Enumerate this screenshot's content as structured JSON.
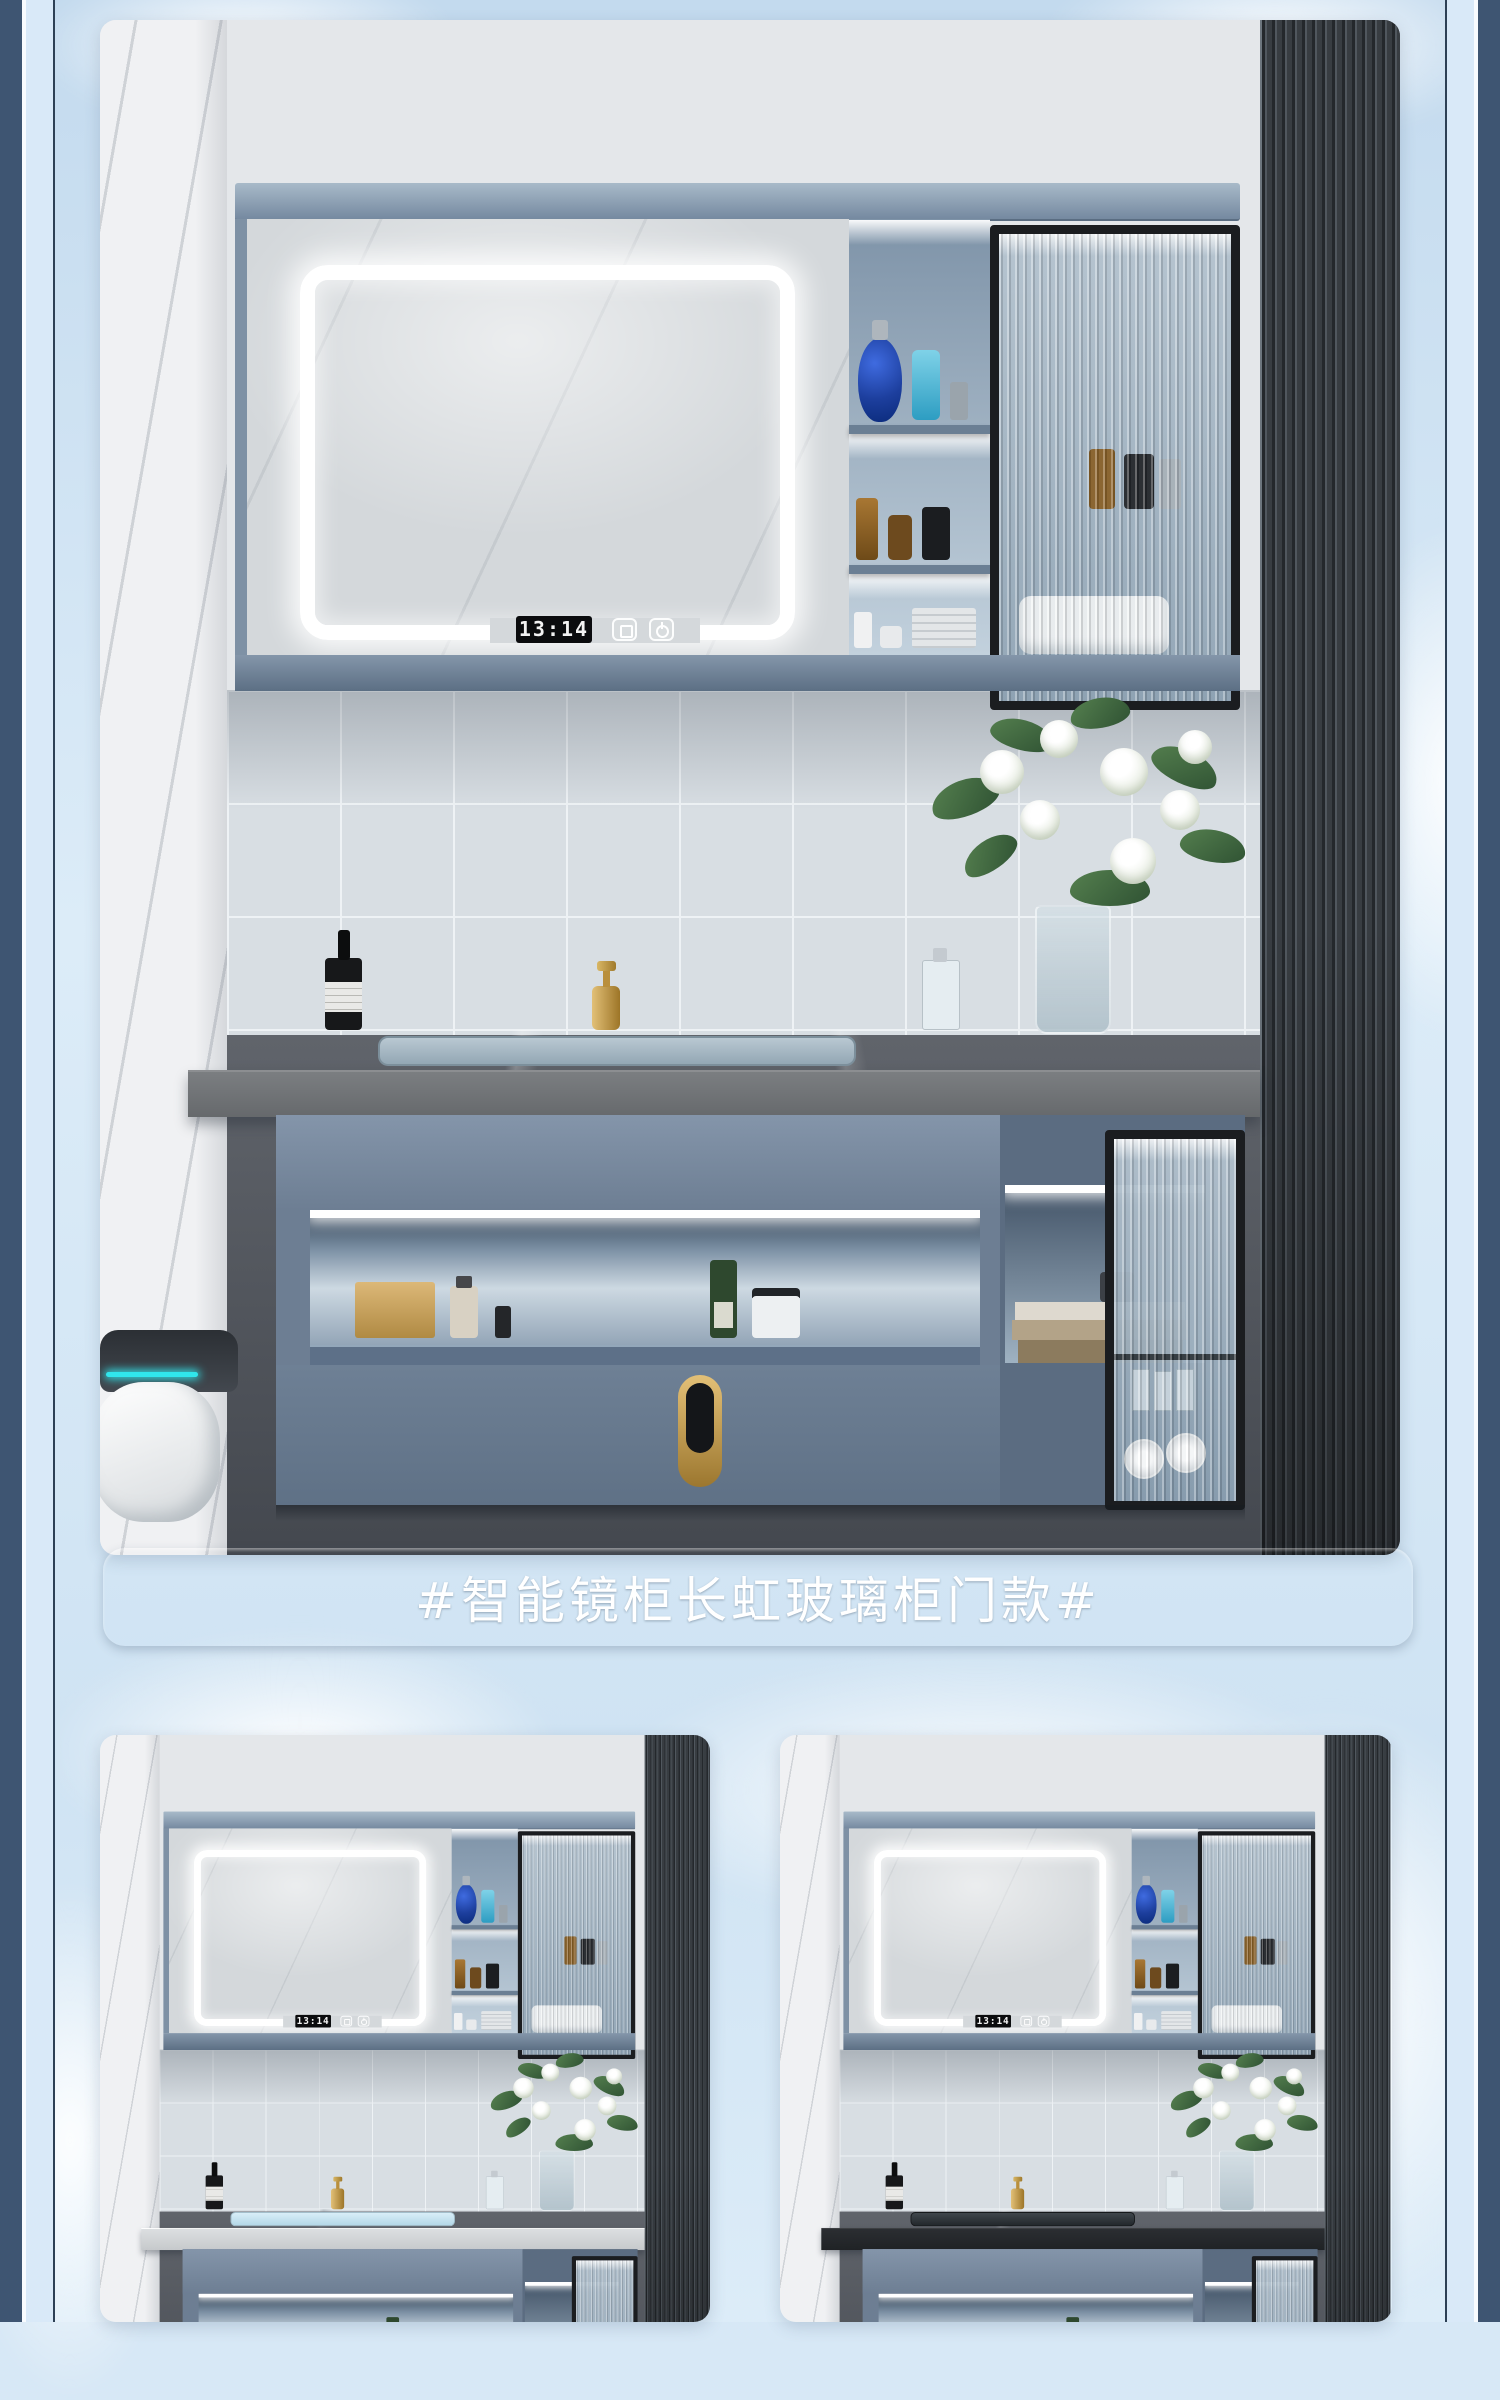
{
  "page": {
    "background_sky": "#d7e8f6",
    "side_rail_color": "#3e5572",
    "rail_line_color": "#2d4055"
  },
  "caption_banner": {
    "text": "#智能镜柜长虹玻璃柜门款#",
    "text_color": "#ffffff",
    "bg_gradient_top": "#93a6bf",
    "bg_gradient_bottom": "#5a6e8e"
  },
  "photos": [
    {
      "name": "main-vanity-photo",
      "counter_variant": "grey-stone",
      "clock_time": "13:14"
    },
    {
      "name": "small-left-photo",
      "counter_variant": "white-marble",
      "clock_time": "13:14"
    },
    {
      "name": "small-right-photo",
      "counter_variant": "black-stone",
      "clock_time": "13:14"
    }
  ],
  "icons": {
    "power_button": "power-icon",
    "defog_button": "defog-icon"
  }
}
